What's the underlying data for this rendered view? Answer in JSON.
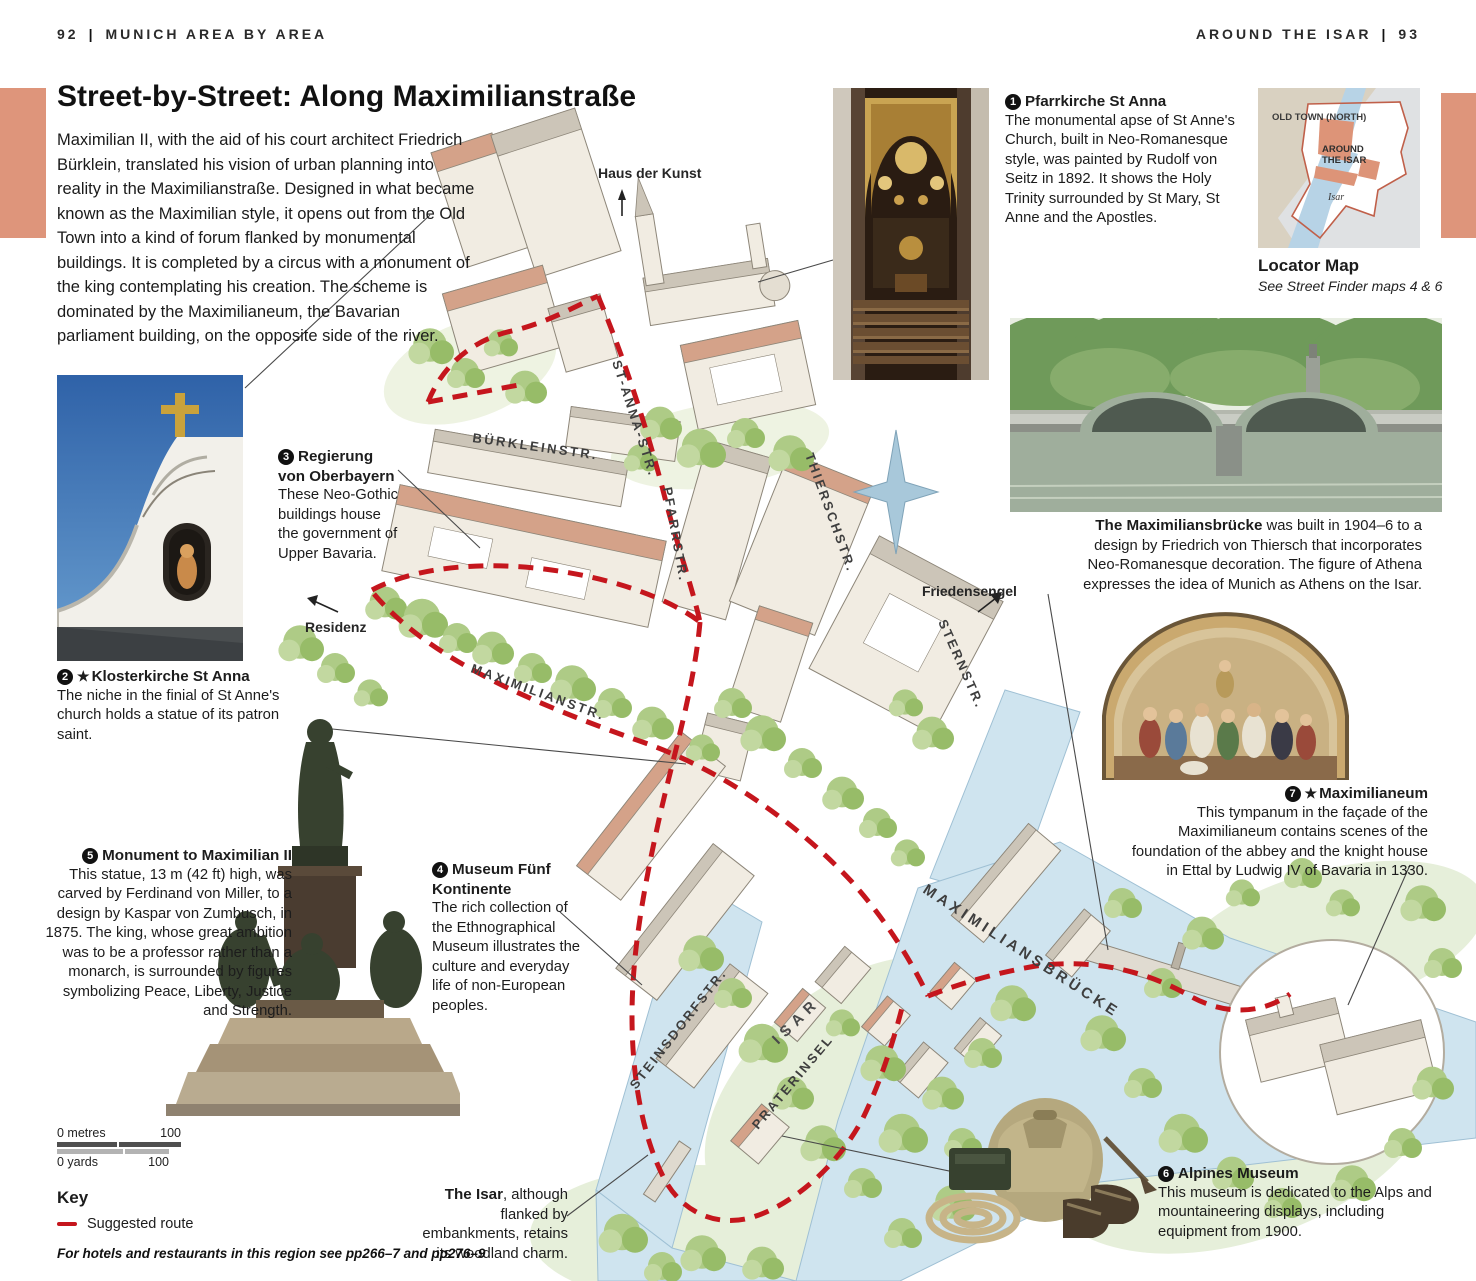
{
  "page": {
    "header_left_num": "92",
    "header_left_title": "MUNICH AREA BY AREA",
    "header_right_title": "AROUND THE ISAR",
    "header_right_num": "93",
    "title": "Street-by-Street: Along Maximilianstraße",
    "intro": "Maximilian II, with the aid of his court architect Friedrich Bürklein, translated his vision of urban planning into reality in the Maximilianstraße. Designed in what became known as the Maximilian style, it opens out from the Old Town into a kind of forum flanked by monumental buildings. It is completed by a circus with a monument of the king contemplating his creation. The scheme is dominated by the Maximilianeum, the Bavarian parliament building, on the opposite side of the river.",
    "footer": "For hotels and restaurants in this region see pp266–7 and pp276–9"
  },
  "annotations": [
    {
      "num": "1",
      "title": "Pfarrkirche St Anna",
      "body": "The monumental apse of St Anne's Church, built in Neo-Romanesque style, was painted by Rudolf von Seitz in 1892. It shows the Holy Trinity surrounded by St Mary, St Anne and the Apostles."
    },
    {
      "num": "2",
      "star": "★",
      "title": "Klosterkirche St Anna",
      "body": "The niche in the finial of St Anne's church holds a statue of its patron saint."
    },
    {
      "num": "3",
      "title": "Regierung von Oberbayern",
      "body": "These Neo-Gothic buildings house the government of Upper Bavaria."
    },
    {
      "num": "4",
      "title": "Museum Fünf Kontinente",
      "body": "The rich collection of the Ethnographical Museum illustrates the culture and everyday life of non-European peoples."
    },
    {
      "num": "5",
      "title": "Monument to Maximilian II",
      "body": "This statue, 13 m (42 ft) high, was carved by Ferdinand von Miller, to a design by Kaspar von Zumbusch, in 1875. The king, whose great ambition was to be a professor rather than a monarch, is surrounded by figures symbolizing Peace, Liberty, Justice and Strength."
    },
    {
      "num": "6",
      "title": "Alpines Museum",
      "body": "This museum is dedicated to the Alps and mountaineering displays, including equipment from 1900."
    },
    {
      "num": "7",
      "star": "★",
      "title": "Maximilianeum",
      "body": "This tympanum in the façade of the Maximilianeum contains scenes of the foundation of the abbey and the knight house in Ettal by Ludwig IV of Bavaria in 1330."
    }
  ],
  "captions": {
    "bruecke_title": "The Maximiliansbrücke",
    "bruecke_body": " was built in 1904–6 to a design by Friedrich von Thiersch that incorporates Neo-Romanesque decoration. The figure of Athena expresses the idea of Munich as Athens on the Isar.",
    "isar_title": "The Isar",
    "isar_body": ", although flanked by embankments, retains its woodland charm."
  },
  "locator": {
    "old_town": "OLD TOWN (NORTH)",
    "around_isar_1": "AROUND",
    "around_isar_2": "THE ISAR",
    "isar": "Isar",
    "caption_title": "Locator Map",
    "caption_sub": "See Street Finder maps 4 & 6"
  },
  "map": {
    "labels": {
      "haus_der_kunst": "Haus der Kunst",
      "st_anna_str": "ST-ANNA-STR.",
      "buerkleinstr": "BÜRKLEINSTR.",
      "pfarrstr": "PFARRSTR.",
      "thierschstr": "THIERSCHSTR.",
      "sternstr": "STERNSTR.",
      "friedensengel": "Friedensengel",
      "residenz": "Residenz",
      "maximilianstr": "MAXIMILIANSTR.",
      "maximiliansbruecke": "MAXIMILIANSBRÜCKE",
      "steinsdorfstr": "STEINSDORFSTR.",
      "isar": "ISAR",
      "praterinsel": "PRATERINSEL"
    }
  },
  "scalebar": {
    "metres_label": "0 metres",
    "metres_value": "100",
    "yards_label": "0 yards",
    "yards_value": "100"
  },
  "key": {
    "title": "Key",
    "route_label": "Suggested route"
  },
  "colors": {
    "accent_salmon": "#de957b",
    "route_red": "#c5161d",
    "river_blue": "#cfe4ef",
    "tree_green": "#aecb86"
  }
}
